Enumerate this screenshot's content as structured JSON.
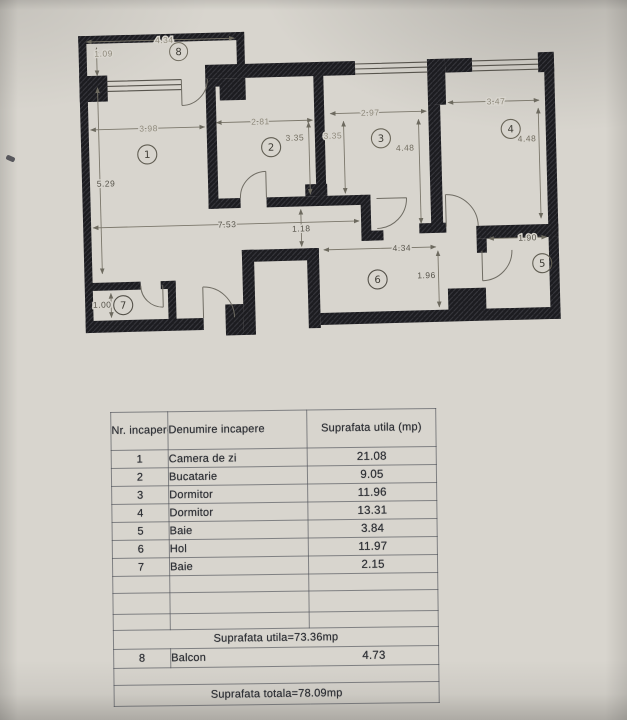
{
  "floorplan": {
    "room_numbers": [
      "1",
      "2",
      "3",
      "4",
      "5",
      "6",
      "7",
      "8"
    ],
    "dim_labels": [
      "4.34",
      "1.09",
      "3.98",
      "5.29",
      "2.81",
      "3.35",
      "3.35",
      "2.97",
      "4.48",
      "3.47",
      "4.48",
      "7.53",
      "1.18",
      "4.34",
      "1.96",
      "1.90",
      "1.00"
    ]
  },
  "table": {
    "headers": {
      "nr": "Nr. incapere",
      "name": "Denumire incapere",
      "area": "Suprafata utila (mp)"
    },
    "rows": [
      {
        "nr": "1",
        "name": "Camera de zi",
        "area": "21.08"
      },
      {
        "nr": "2",
        "name": "Bucatarie",
        "area": "9.05"
      },
      {
        "nr": "3",
        "name": "Dormitor",
        "area": "11.96"
      },
      {
        "nr": "4",
        "name": "Dormitor",
        "area": "13.31"
      },
      {
        "nr": "5",
        "name": "Baie",
        "area": "3.84"
      },
      {
        "nr": "6",
        "name": "Hol",
        "area": "11.97"
      },
      {
        "nr": "7",
        "name": "Baie",
        "area": "2.15"
      }
    ],
    "subtotal": "Suprafata utila=73.36mp",
    "balcony_row": {
      "nr": "8",
      "name": "Balcon",
      "area": "4.73"
    },
    "total": "Suprafata totala=78.09mp"
  }
}
